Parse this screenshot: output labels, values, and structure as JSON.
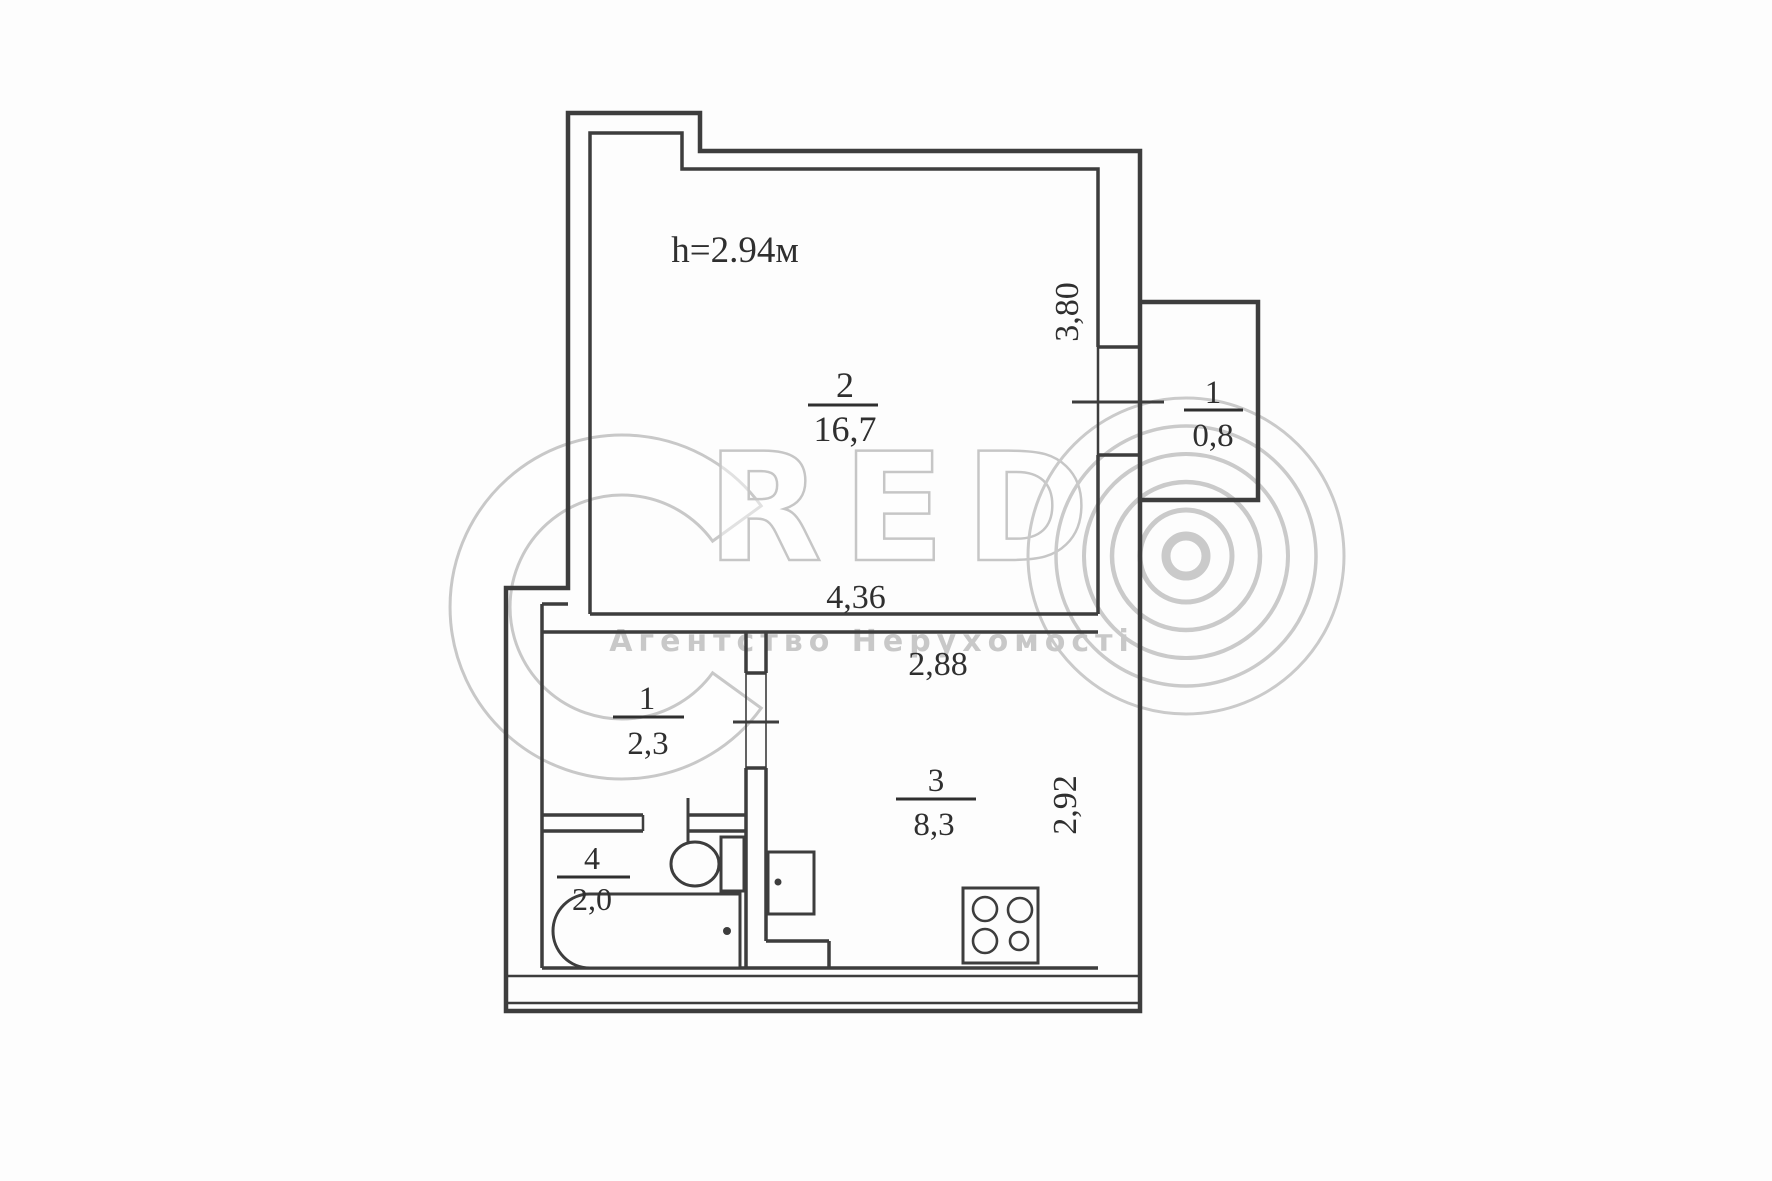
{
  "plan": {
    "ceiling_height_label": "h=2.94м",
    "rooms": [
      {
        "id": "living-room",
        "number": "2",
        "area": "16,7"
      },
      {
        "id": "balcony",
        "number": "1",
        "area": "0,8"
      },
      {
        "id": "hallway",
        "number": "1",
        "area": "2,3"
      },
      {
        "id": "kitchen",
        "number": "3",
        "area": "8,3"
      },
      {
        "id": "bathroom",
        "number": "4",
        "area": "2,0"
      }
    ],
    "dimensions": [
      {
        "id": "dim-right-upper",
        "value": "3,80",
        "orientation": "vertical"
      },
      {
        "id": "dim-room-width",
        "value": "4,36",
        "orientation": "horizontal"
      },
      {
        "id": "dim-kitchen-width",
        "value": "2,88",
        "orientation": "horizontal"
      },
      {
        "id": "dim-kitchen-depth",
        "value": "2,92",
        "orientation": "vertical"
      }
    ],
    "fixtures": [
      "bathtub",
      "toilet",
      "sink",
      "stove"
    ],
    "line_color": "#3d3d3d"
  },
  "watermark": {
    "brand_c": "C",
    "brand_rest": "RED",
    "rings_icon": "concentric-rings-o",
    "subtitle": "Агентство Нерухомості",
    "color": "#c8c8c8"
  }
}
